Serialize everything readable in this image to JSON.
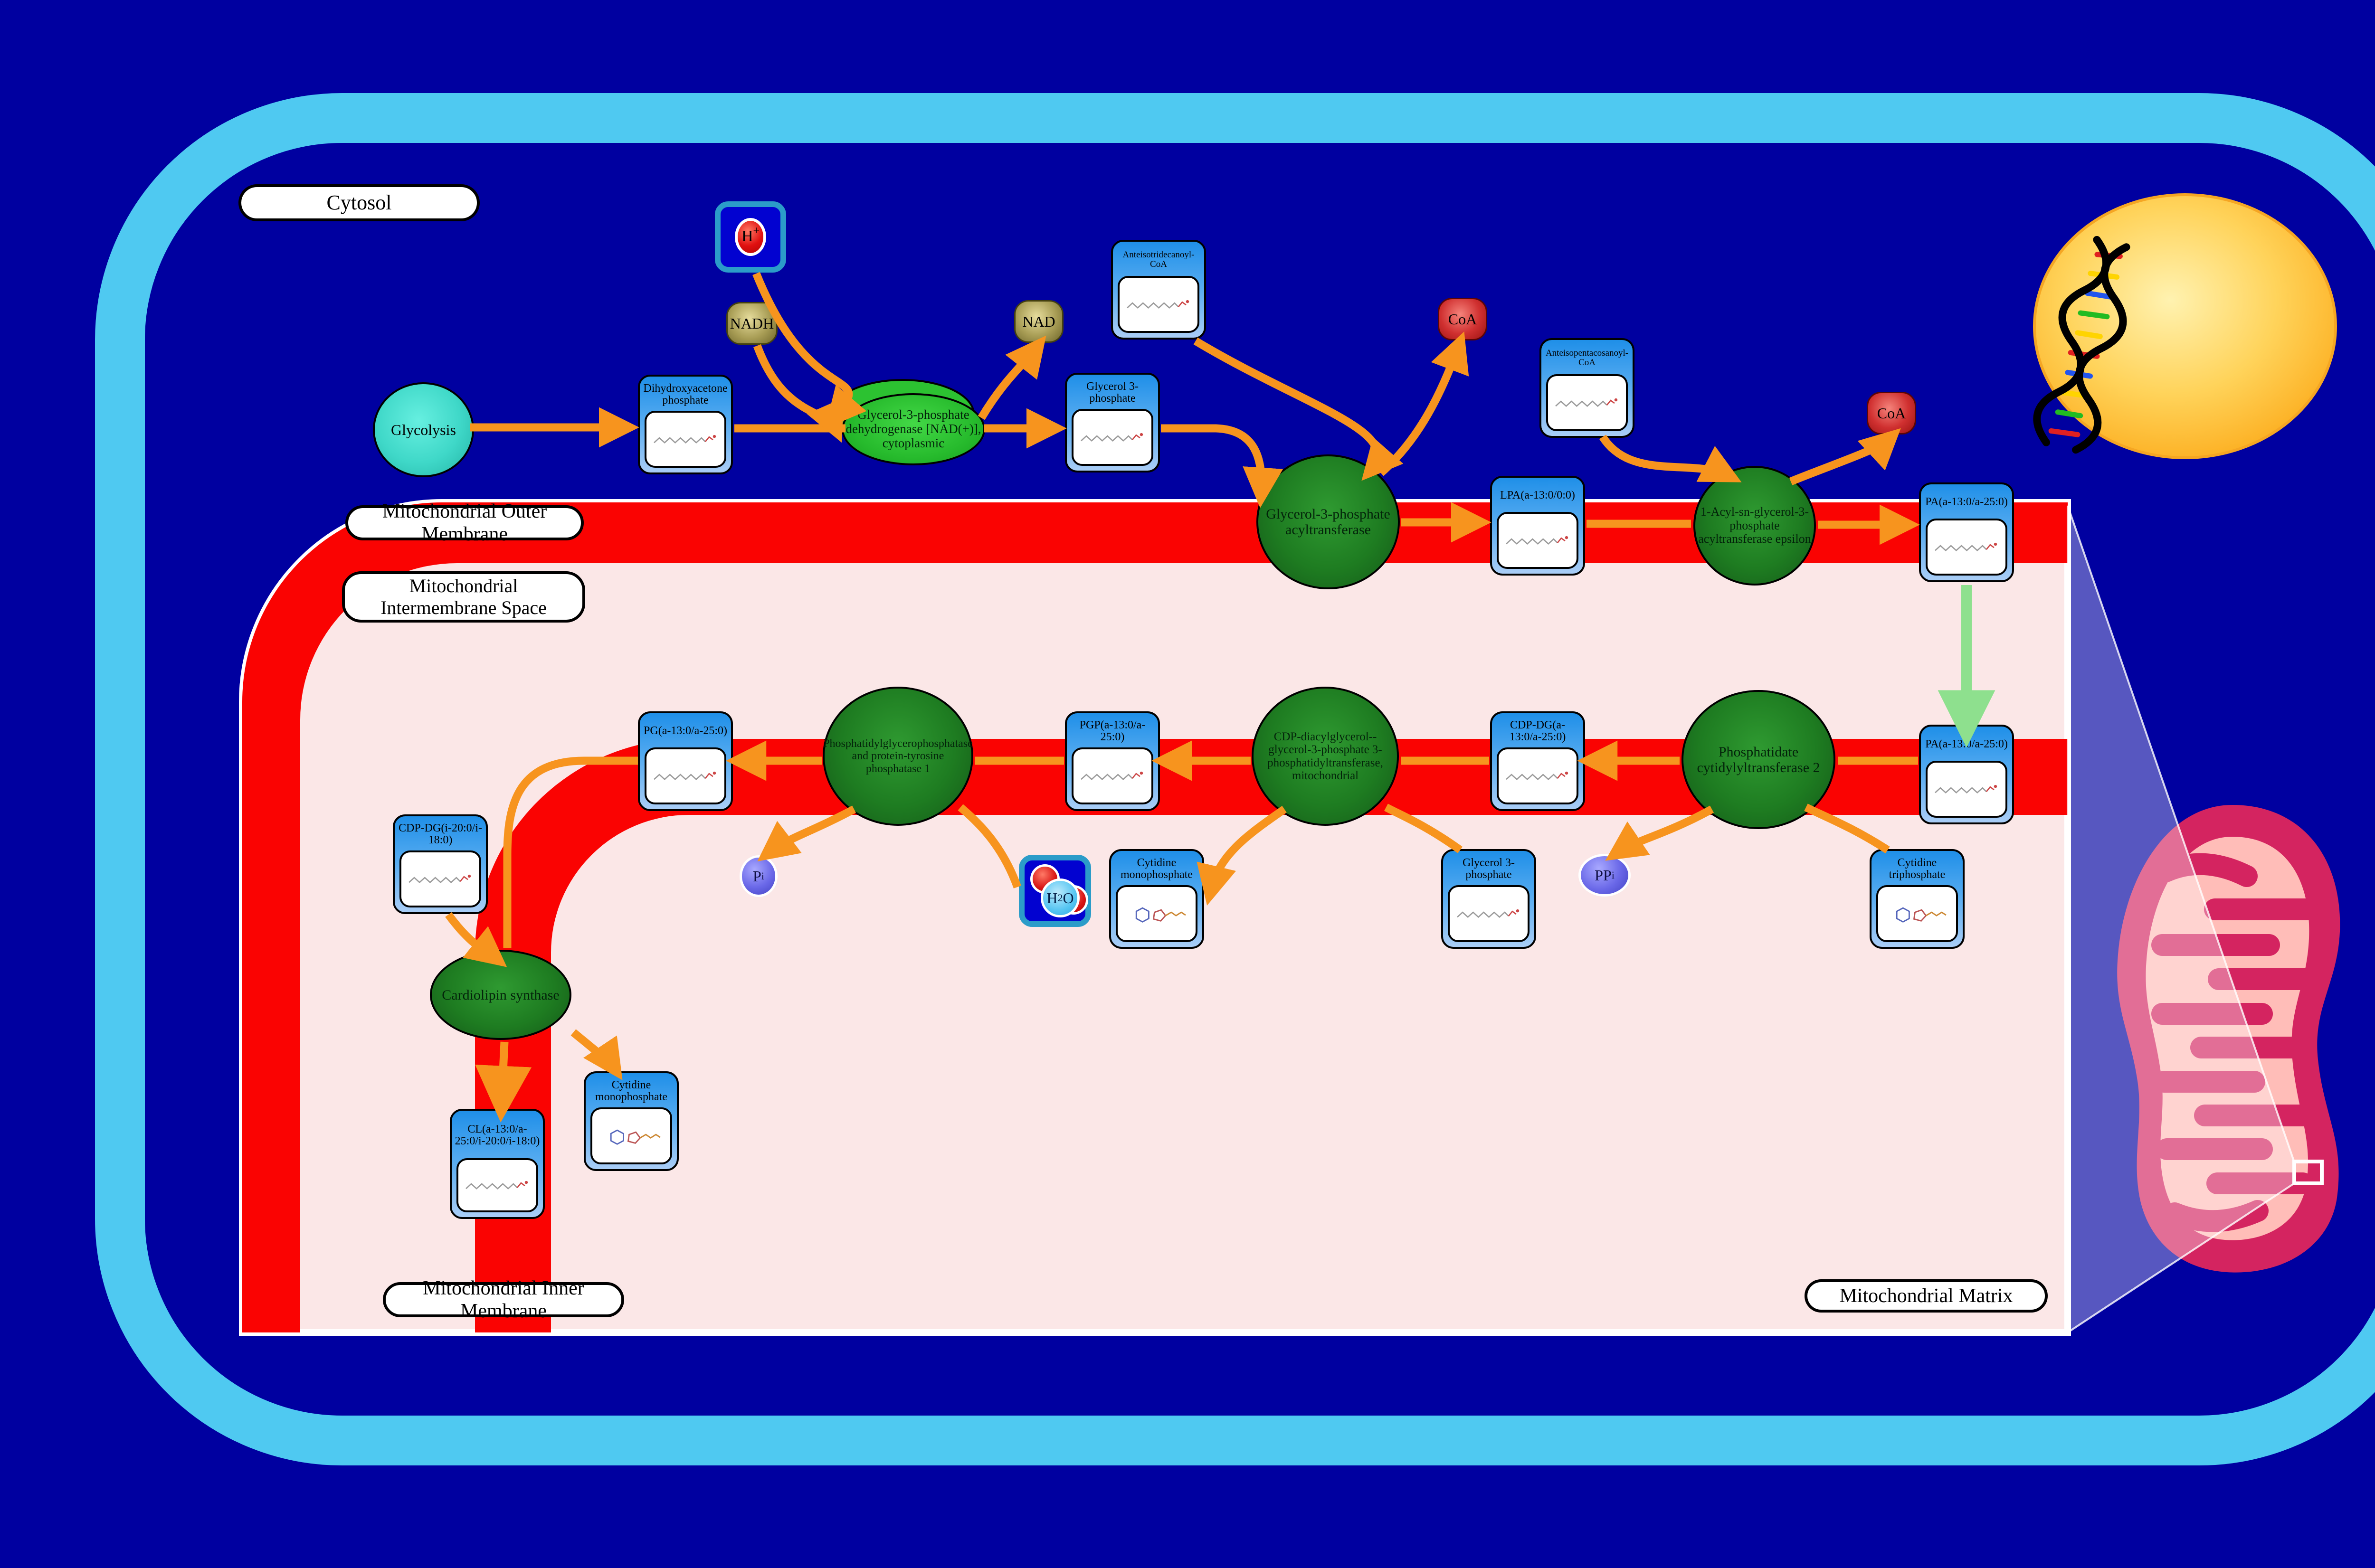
{
  "regions": {
    "cytosol": "Cytosol",
    "outer_membrane": "Mitochondrial Outer Membrane",
    "intermembrane_space": "Mitochondrial Intermembrane Space",
    "inner_membrane": "Mitochondrial Inner Membrane",
    "matrix": "Mitochondrial Matrix"
  },
  "process": {
    "glycolysis": "Glycolysis"
  },
  "enzymes": {
    "gpd": "Glycerol-3-phosphate dehydrogenase [NAD(+)], cytoplasmic",
    "gpat": "Glycerol-3-phosphate acyltransferase",
    "agpat": "1-Acyl-sn-glycerol-3-phosphate acyltransferase epsilon",
    "pct2": "Phosphatidate cytidylyltransferase 2",
    "pgs": "CDP-diacylglycerol--glycerol-3-phosphate 3-phosphatidyltransferase, mitochondrial",
    "pgpase": "Phosphatidylglycerophosphatase and protein-tyrosine phosphatase 1",
    "cls": "Cardiolipin synthase"
  },
  "nodes": {
    "dhap": "Dihydroxyacetone phosphate",
    "g3p_top": "Glycerol 3-phosphate",
    "a13coa": "Anteisotridecanoyl-CoA",
    "lpa": "LPA(a-13:0/0:0)",
    "a25coa": "Anteisopentacosanoyl-CoA",
    "pa_outer": "PA(a-13:0/a-25:0)",
    "pa_inner": "PA(a-13:0/a-25:0)",
    "cdpdg_a": "CDP-DG(a-13:0/a-25:0)",
    "pgp": "PGP(a-13:0/a-25:0)",
    "pg": "PG(a-13:0/a-25:0)",
    "cdpdg_i": "CDP-DG(i-20:0/i-18:0)",
    "cl": "CL(a-13:0/a-25:0/i-20:0/i-18:0)",
    "cmp_matrix": "Cytidine monophosphate",
    "g3p_matrix": "Glycerol 3-phosphate",
    "ctp": "Cytidine triphosphate",
    "cmp_cls": "Cytidine monophosphate"
  },
  "cofactors": {
    "nadh": "NADH",
    "nad": "NAD",
    "coa_gpat": "CoA",
    "coa_agpat": "CoA",
    "h_plus": {
      "base": "H",
      "sup": "+"
    },
    "h2o": {
      "base": "H",
      "sub": "2",
      "tail": "O"
    },
    "pi": {
      "base": "P",
      "sub": "i"
    },
    "ppi": {
      "base": "PP",
      "sub": "i"
    }
  },
  "colors": {
    "background": "#0000A0",
    "cell_border": "#4FC9F1",
    "membrane_red": "#FA0302",
    "matrix_pink": "#FBE7E7",
    "arrow_orange": "#F7941E",
    "transport_green": "#8EE08E",
    "enzyme_green": "#1E7C21",
    "box_blue": "#2F9BEF",
    "nucleus_yellow": "#FDB827",
    "mitochondrion_crimson": "#D42460"
  }
}
